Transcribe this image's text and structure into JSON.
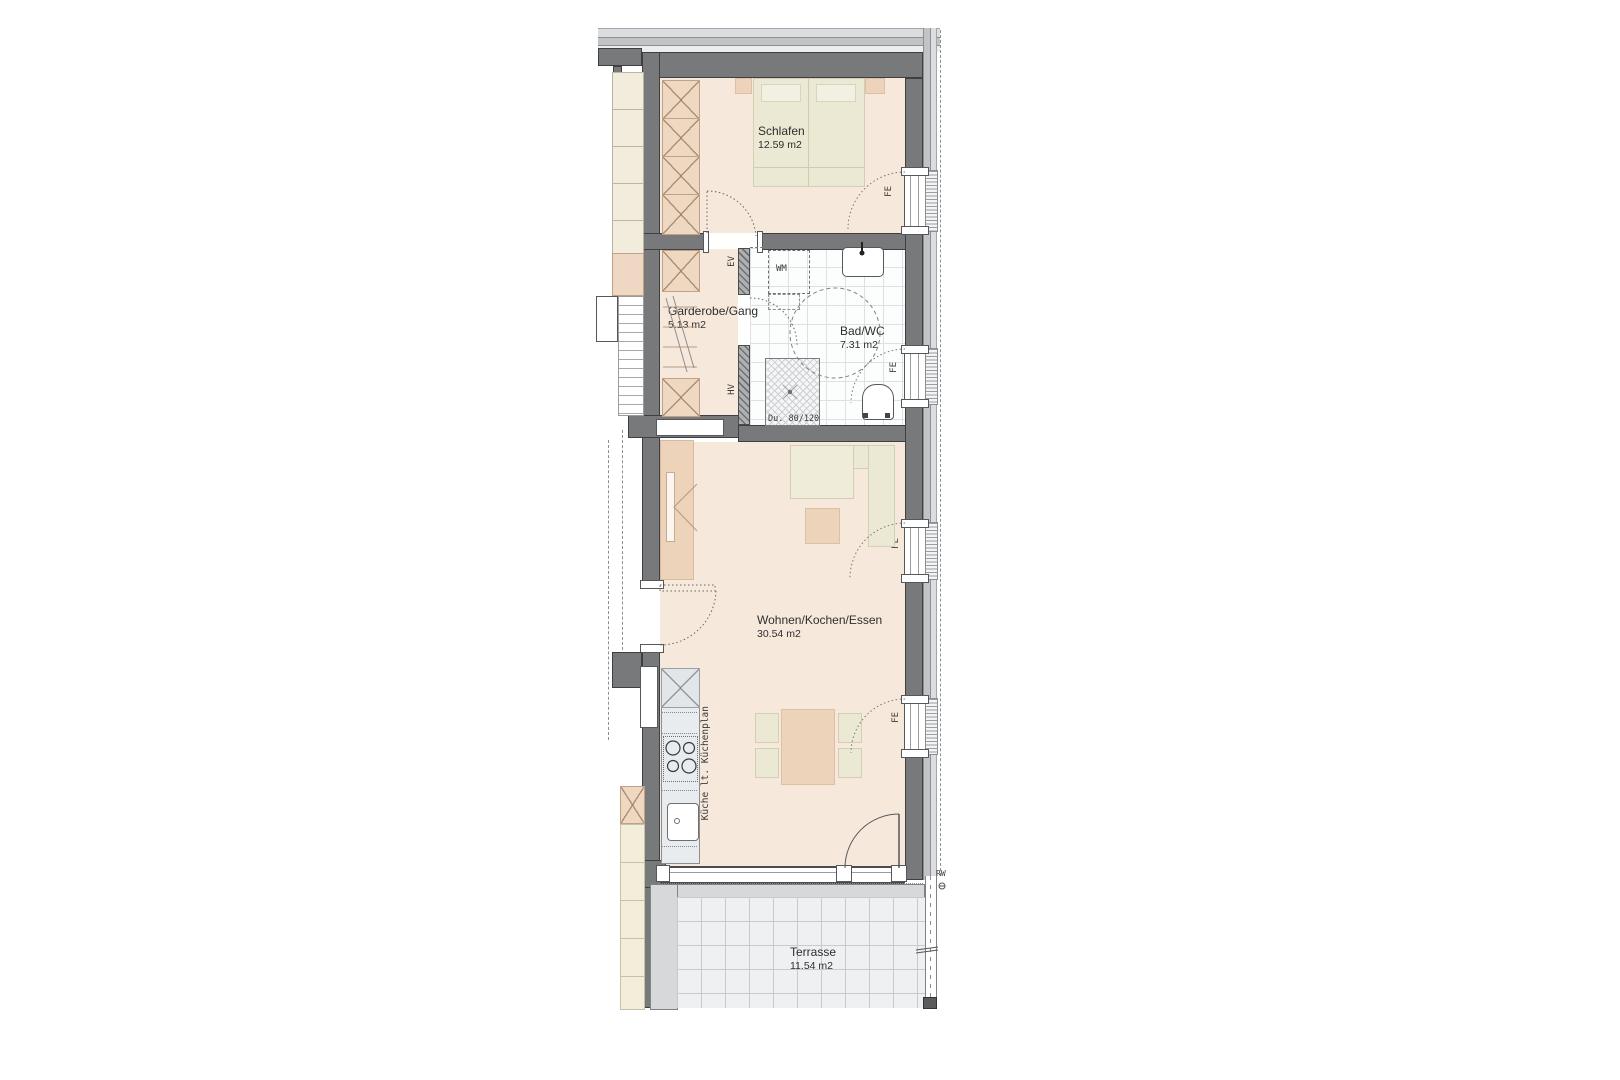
{
  "plan": {
    "title": "Apartment floor plan",
    "rooms": [
      {
        "id": "schlafen",
        "name": "Schlafen",
        "area": "12.59 m2"
      },
      {
        "id": "garderobe",
        "name": "Garderobe/Gang",
        "area": "5.13 m2"
      },
      {
        "id": "bad",
        "name": "Bad/WC",
        "area": "7.31 m2"
      },
      {
        "id": "wohnen",
        "name": "Wohnen/Kochen/Essen",
        "area": "30.54 m2"
      },
      {
        "id": "terrasse",
        "name": "Terrasse",
        "area": "11.54 m2"
      }
    ],
    "annotations": {
      "window": "FE",
      "electrical": "EV",
      "heating": "HV",
      "washing_machine": "WM",
      "shower_size": "Du. 80/120",
      "kitchen_note": "Küche lt. Küchenplan",
      "rainwater": "RW"
    },
    "colors": {
      "floor": "#f6e9dc",
      "furniture_tan": "#ecd3ba",
      "furniture_beige": "#ebe8d3",
      "kitchen_counter": "#e9ecef",
      "wall": "#78797b",
      "bath_tile": "#fcfdfd",
      "terrace_tile": "#eef0f2"
    }
  }
}
